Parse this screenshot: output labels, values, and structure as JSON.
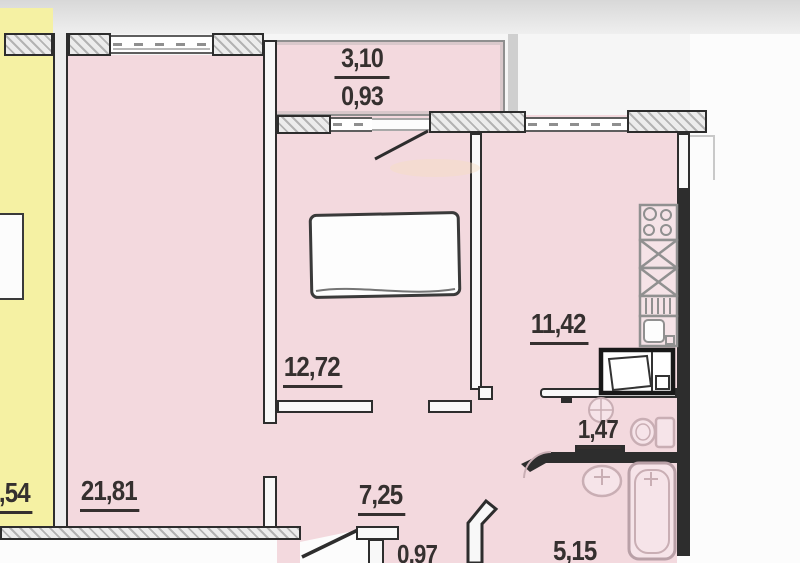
{
  "labels": {
    "balcony_width": "3,10",
    "balcony_area": "0,93",
    "neighbor": ",54",
    "living": "21,81",
    "bedroom": "12,72",
    "kitchen": "11,42",
    "wc": "1,47",
    "hall": "7,25",
    "closet": "0,97",
    "bath": "5,15"
  },
  "colors": {
    "apartment_fill": "#f3d9de",
    "neighbor_fill": "#f5f1a3",
    "wall": "#2d2d2d",
    "fixture_outline": "#c9aeb4",
    "label_text": "#35302f"
  },
  "fixtures": [
    "bed",
    "stove-icon",
    "kitchen-cabinet-icon",
    "sink-drainer-icon",
    "kitchen-sink-icon",
    "refrigerator-icon",
    "wc-washbasin-icon",
    "toilet-icon",
    "washbasin-icon",
    "bathtub-icon",
    "balcony-door",
    "entrance-door",
    "door-arc"
  ]
}
